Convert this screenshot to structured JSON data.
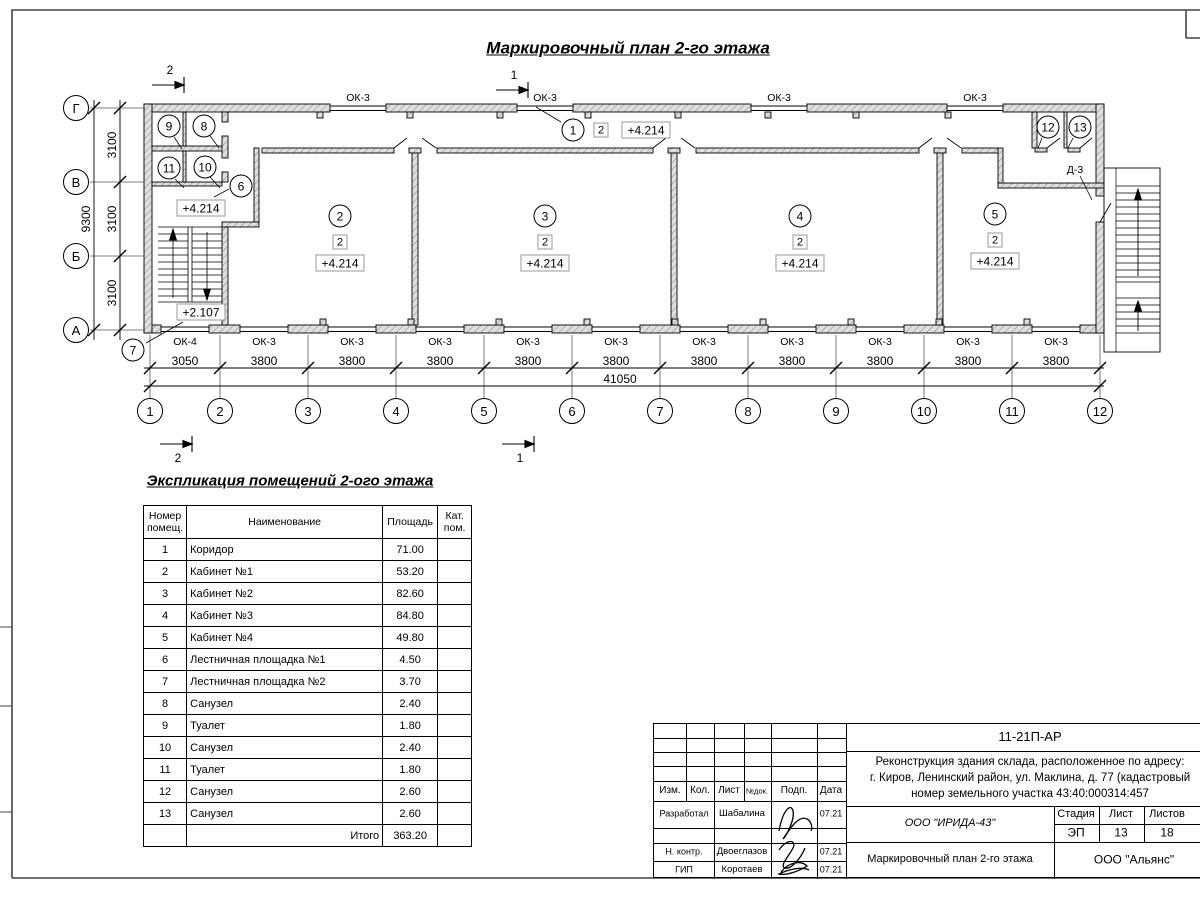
{
  "drawing_title": "Маркировочный план 2-го этажа",
  "plan": {
    "sections": [
      "2",
      "1"
    ],
    "axes_h": [
      "1",
      "2",
      "3",
      "4",
      "5",
      "6",
      "7",
      "8",
      "9",
      "10",
      "11",
      "12"
    ],
    "axes_v": [
      "Г",
      "В",
      "Б",
      "А"
    ],
    "dims_h": [
      "3050",
      "3800",
      "3800",
      "3800",
      "3800",
      "3800",
      "3800",
      "3800",
      "3800",
      "3800",
      "3800"
    ],
    "dim_h_total": "41050",
    "dims_v": [
      "3100",
      "3100",
      "3100"
    ],
    "dim_v_total": "9300",
    "windows_top": [
      "ОК-3",
      "ОК-3",
      "ОК-3",
      "ОК-3"
    ],
    "windows_bottom": [
      "ОК-4",
      "ОК-3",
      "ОК-3",
      "ОК-3",
      "ОК-3",
      "ОК-3",
      "ОК-3",
      "ОК-3",
      "ОК-3",
      "ОК-3",
      "ОК-3"
    ],
    "door_tag": "Д-3",
    "rooms": [
      {
        "num": "1",
        "cat": "2",
        "elev": "+4.214"
      },
      {
        "num": "2",
        "cat": "2",
        "elev": "+4.214"
      },
      {
        "num": "3",
        "cat": "2",
        "elev": "+4.214"
      },
      {
        "num": "4",
        "cat": "2",
        "elev": "+4.214"
      },
      {
        "num": "5",
        "cat": "2",
        "elev": "+4.214"
      }
    ],
    "small_rooms": [
      "9",
      "8",
      "11",
      "10",
      "6",
      "12",
      "13",
      "7"
    ],
    "elev_landing": "+4.214",
    "elev_mid": "+2.107"
  },
  "explication": {
    "title": "Экспликация помещений 2-ого этажа",
    "headers": {
      "num": "Номер помещ.",
      "name": "Наименование",
      "area": "Площадь",
      "cat": "Кат. пом."
    },
    "rows": [
      {
        "num": "1",
        "name": "Коридор",
        "area": "71.00"
      },
      {
        "num": "2",
        "name": "Кабинет №1",
        "area": "53.20"
      },
      {
        "num": "3",
        "name": "Кабинет №2",
        "area": "82.60"
      },
      {
        "num": "4",
        "name": "Кабинет №3",
        "area": "84.80"
      },
      {
        "num": "5",
        "name": "Кабинет №4",
        "area": "49.80"
      },
      {
        "num": "6",
        "name": "Лестничная площадка №1",
        "area": "4.50"
      },
      {
        "num": "7",
        "name": "Лестничная площадка №2",
        "area": "3.70"
      },
      {
        "num": "8",
        "name": "Санузел",
        "area": "2.40"
      },
      {
        "num": "9",
        "name": "Туалет",
        "area": "1.80"
      },
      {
        "num": "10",
        "name": "Санузел",
        "area": "2.40"
      },
      {
        "num": "11",
        "name": "Туалет",
        "area": "1.80"
      },
      {
        "num": "12",
        "name": "Санузел",
        "area": "2.60"
      },
      {
        "num": "13",
        "name": "Санузел",
        "area": "2.60"
      }
    ],
    "total_label": "Итого",
    "total_value": "363.20"
  },
  "titleblock": {
    "doc_code": "11-21П-АР",
    "project_lines": [
      "Реконструкция здания склада, расположенное по адресу:",
      "г. Киров, Ленинский район, ул. Маклина, д. 77 (кадастровый",
      "номер земельного участка 43:40:000314:457"
    ],
    "cols": [
      "Изм.",
      "Кол.",
      "Лист",
      "№док.",
      "Подп.",
      "Дата"
    ],
    "staff": [
      {
        "role": "Разработал",
        "name": "Шабалина",
        "date": "07.21"
      },
      {
        "role": "Н. контр.",
        "name": "Двоеглазов",
        "date": "07.21"
      },
      {
        "role": "ГИП",
        "name": "Коротаев",
        "date": "07.21"
      }
    ],
    "org": "ООО \"ИРИДА-43\"",
    "doc_title": "Маркировочный план 2-го этажа",
    "stage_cols": [
      "Стадия",
      "Лист",
      "Листов"
    ],
    "stage_vals": [
      "ЭП",
      "13",
      "18"
    ],
    "contractor": "ООО \"Альянс\""
  }
}
